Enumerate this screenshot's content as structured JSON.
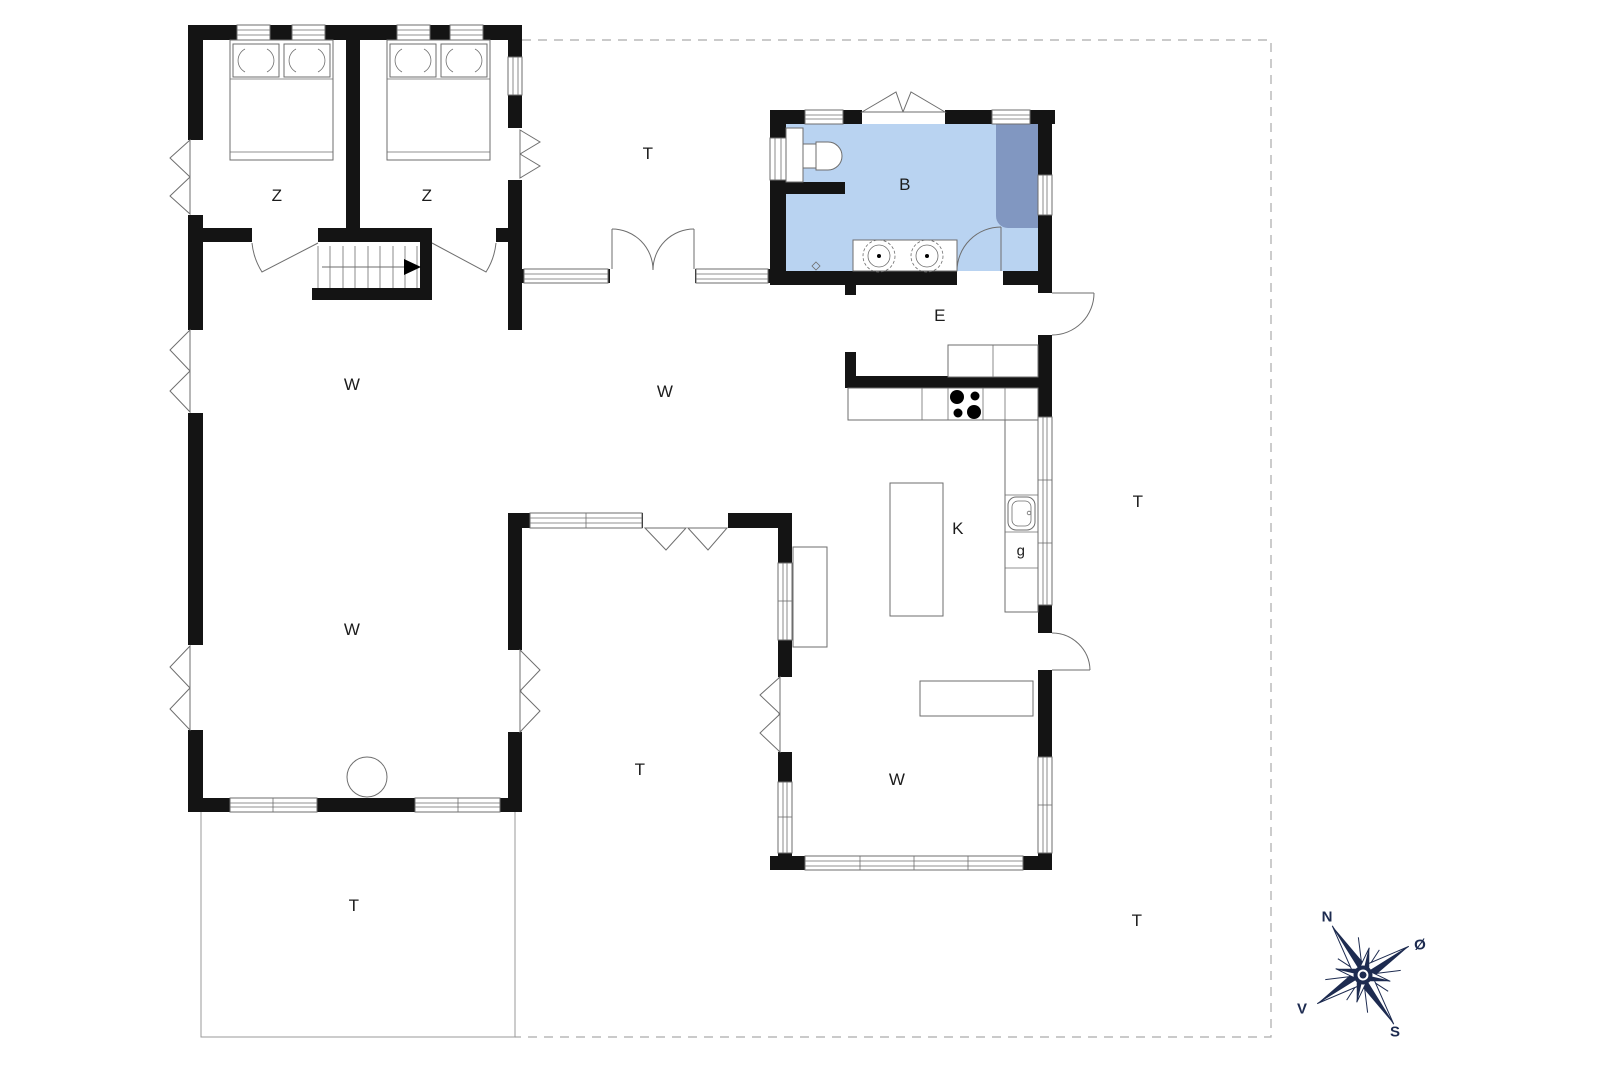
{
  "colors": {
    "wall": "#141414",
    "line": "#6e6e6e",
    "bath_fill": "#b9d3f1",
    "shower_fill": "#8197c1",
    "dashed_line": "#ababab",
    "terrace_line": "#9a9a9a",
    "compass_navy": "#1d2b50",
    "label_text": "#1c1c1c"
  },
  "labels": {
    "bedroom1": "Z",
    "bedroom2": "Z",
    "bathroom": "B",
    "entrance": "E",
    "kitchen": "K",
    "appliance": "g",
    "living_nw": "W",
    "living_mid": "W",
    "living_sw": "W",
    "living_se": "W",
    "terrace_north": "T",
    "terrace_east": "T",
    "terrace_mid": "T",
    "terrace_sw": "T",
    "terrace_se": "T"
  },
  "compass": {
    "north": "N",
    "east": "Ø",
    "south": "S",
    "west": "V"
  },
  "icons": {
    "compass": "compass-rose-icon",
    "wood_stove": "wood-stove-icon",
    "cooktop": "cooktop-burners-icon",
    "sink": "kitchen-sink-icon",
    "toilet": "toilet-icon",
    "shower": "shower-mat-icon",
    "bed": "double-bed-icon",
    "stairs": "staircase-icon"
  }
}
